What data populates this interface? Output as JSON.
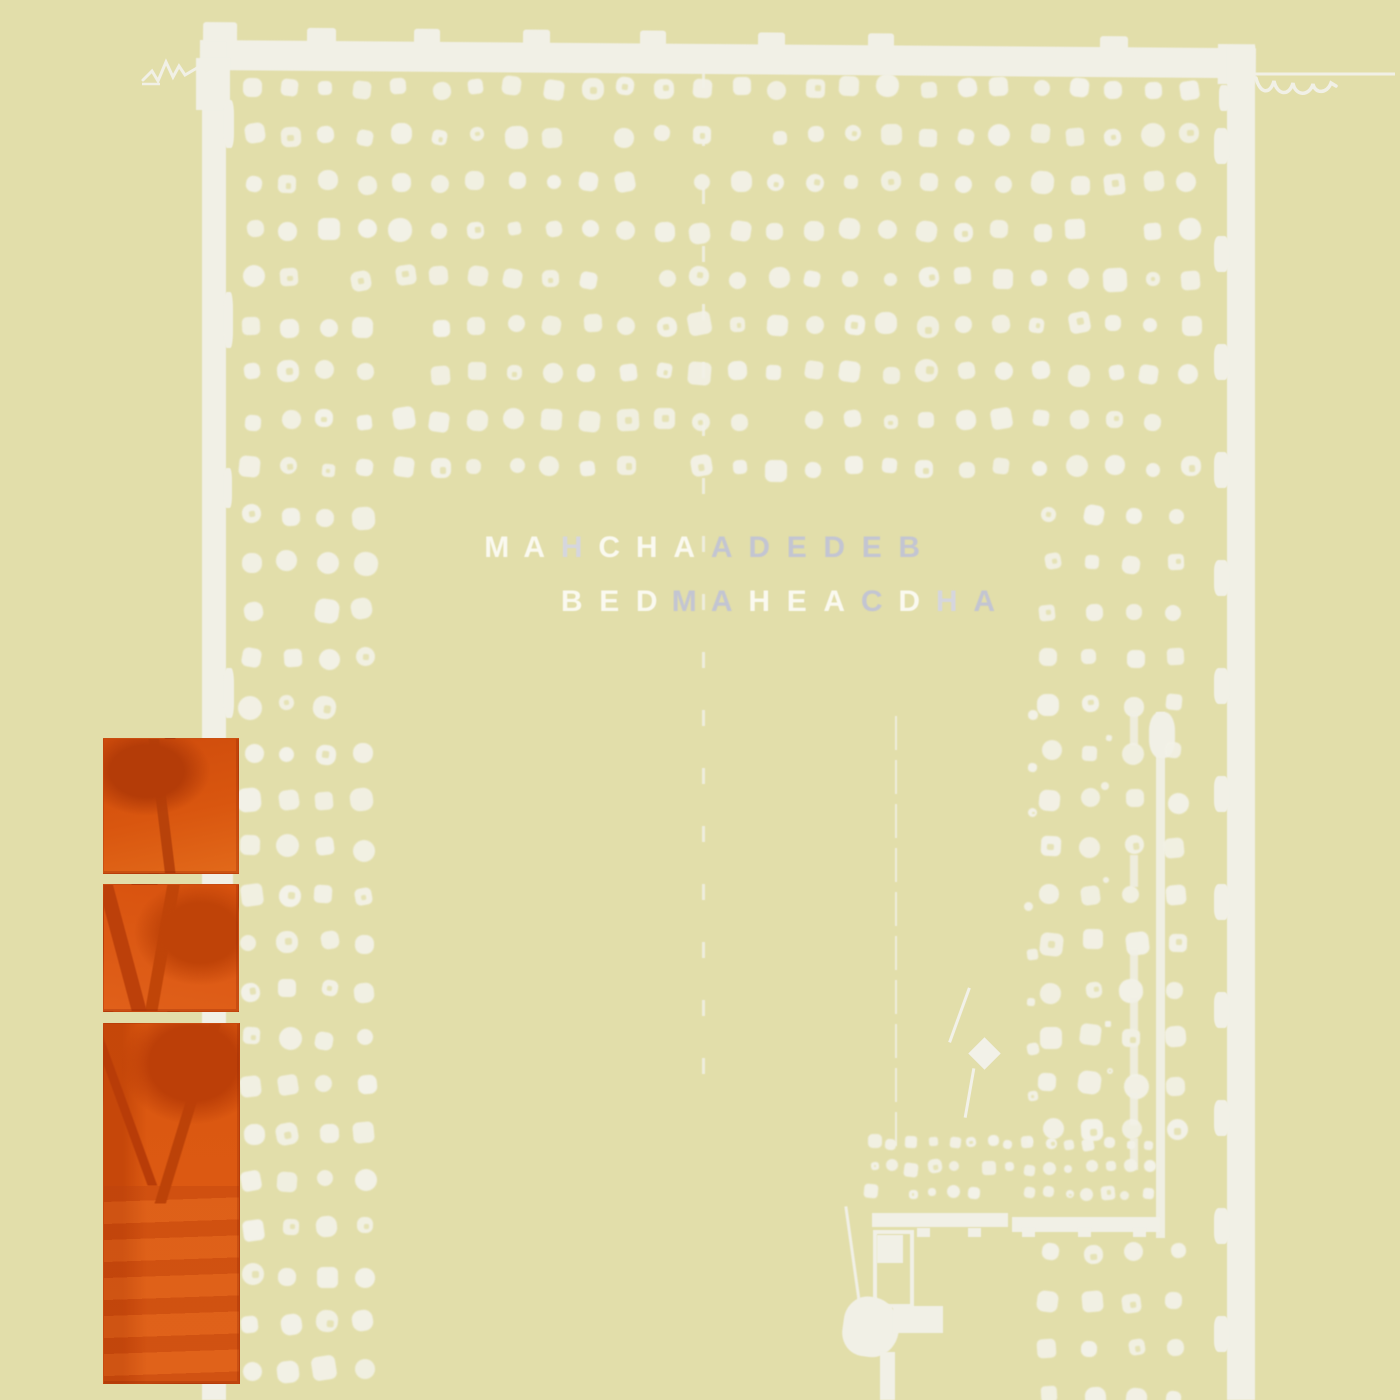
{
  "alt_text": "Pale khaki album-cover artwork: halftone field of off-white dots forming a building-like arch, white irregular frame strips on top/left/right, interleaved band-name lettering in the middle, three orange tree photo panels stacked at lower left, small machinery shapes at lower right.",
  "palette": {
    "background": "#e2deaa",
    "dot_white": "#f3f2e8",
    "frame_white": "#f1f0e6",
    "letter_white": "#faf9f0",
    "letter_gray": "#c3c5d2",
    "letter_faint": "#d5d6de",
    "orange_base": "#d9560f",
    "orange_dark": "#b83c08",
    "orange_light": "#e2691a"
  },
  "title": {
    "font_size": 30,
    "advance": 37.5,
    "line1": {
      "x": 478,
      "y": 531,
      "letters": [
        [
          "M",
          "white"
        ],
        [
          "A",
          "white"
        ],
        [
          "H",
          "faint"
        ],
        [
          "C",
          "white"
        ],
        [
          "H",
          "white"
        ],
        [
          "A",
          "white"
        ],
        [
          "A",
          "gray"
        ],
        [
          "D",
          "gray"
        ],
        [
          "E",
          "gray"
        ],
        [
          "D",
          "gray"
        ],
        [
          "E",
          "gray"
        ],
        [
          "B",
          "gray"
        ]
      ]
    },
    "line2": {
      "x": 553,
      "y": 585,
      "letters": [
        [
          "B",
          "white"
        ],
        [
          "E",
          "white"
        ],
        [
          "D",
          "white"
        ],
        [
          "M",
          "gray"
        ],
        [
          "A",
          "gray"
        ],
        [
          "H",
          "white"
        ],
        [
          "E",
          "white"
        ],
        [
          "A",
          "white"
        ],
        [
          "C",
          "gray"
        ],
        [
          "D",
          "white"
        ],
        [
          "H",
          "faint"
        ],
        [
          "A",
          "gray"
        ]
      ]
    }
  },
  "pattern": {
    "seed": 1337,
    "grid": {
      "x0": 252,
      "y0": 88,
      "dx": 37.5,
      "dy": 47.5,
      "cols": 26,
      "full_rows": 9,
      "left_cols": 4,
      "left_row_start": 9,
      "left_row_end": 27
    },
    "right_cols": [
      1050,
      1092,
      1134,
      1176
    ],
    "right_clean_rows": [
      515,
      562,
      610,
      657
    ],
    "right_messy_rows": [
      705,
      752,
      800,
      847,
      895,
      942,
      990,
      1037,
      1085,
      1130
    ],
    "mini_band": {
      "x0": 874,
      "y0": 1143,
      "dx": 19.5,
      "dy": 25,
      "cols": 15,
      "rows": 3,
      "size": 11
    },
    "bottom_block": {
      "cols": [
        1050,
        1092,
        1134,
        1176
      ],
      "rows": [
        1253,
        1301,
        1349,
        1397
      ]
    }
  },
  "frame": {
    "top_band": {
      "x": 200,
      "y": 40,
      "w": 1056,
      "h": 30,
      "bumps": [
        {
          "x": 203,
          "w": 34,
          "up": 18,
          "h": 48
        },
        {
          "x": 307,
          "w": 29,
          "up": 13,
          "h": 16
        },
        {
          "x": 414,
          "w": 26,
          "up": 13,
          "h": 16
        },
        {
          "x": 523,
          "w": 27,
          "up": 13,
          "h": 16
        },
        {
          "x": 640,
          "w": 26,
          "up": 13,
          "h": 16
        },
        {
          "x": 758,
          "w": 27,
          "up": 12,
          "h": 15
        },
        {
          "x": 868,
          "w": 26,
          "up": 12,
          "h": 15
        },
        {
          "x": 1100,
          "w": 28,
          "up": 11,
          "h": 14
        }
      ],
      "corner_block": {
        "x": 1218,
        "w": 37,
        "up": 4,
        "h": 40
      }
    },
    "left_bar": {
      "x": 202,
      "w": 24,
      "y0": 42,
      "y1": 1400,
      "head": {
        "x": 196,
        "y": 58,
        "w": 34,
        "h": 52
      },
      "tabs": [
        {
          "y": 100,
          "h": 48,
          "w": 10
        },
        {
          "y": 292,
          "h": 56,
          "w": 9
        },
        {
          "y": 468,
          "h": 40,
          "w": 8
        },
        {
          "y": 668,
          "h": 50,
          "w": 10
        },
        {
          "y": 856,
          "h": 44,
          "w": 9
        },
        {
          "y": 1050,
          "h": 40,
          "w": 8
        },
        {
          "y": 1244,
          "h": 46,
          "w": 9
        }
      ]
    },
    "right_bar": {
      "x": 1227,
      "w": 28,
      "y0": 46,
      "y1": 1400,
      "tabs": [
        {
          "y": 85,
          "h": 26,
          "w": 10
        },
        {
          "y": 128,
          "h": 36,
          "w": 15
        },
        {
          "y": 236,
          "h": 36,
          "w": 15
        },
        {
          "y": 344,
          "h": 36,
          "w": 15
        },
        {
          "y": 452,
          "h": 36,
          "w": 15
        },
        {
          "y": 560,
          "h": 36,
          "w": 15
        },
        {
          "y": 668,
          "h": 36,
          "w": 15
        },
        {
          "y": 776,
          "h": 36,
          "w": 15
        },
        {
          "y": 884,
          "h": 36,
          "w": 15
        },
        {
          "y": 992,
          "h": 36,
          "w": 15
        },
        {
          "y": 1100,
          "h": 36,
          "w": 15
        },
        {
          "y": 1208,
          "h": 36,
          "w": 15
        },
        {
          "y": 1316,
          "h": 36,
          "w": 15
        }
      ]
    }
  },
  "lines": {
    "center_dashed": {
      "x": 702,
      "y0": 72,
      "y1": 1092,
      "w": 3,
      "dash": 16,
      "gap": 42
    },
    "mid_thin": {
      "x": 895,
      "y0": 716,
      "y1": 1146,
      "w": 2,
      "dash": 34,
      "gap": 10
    },
    "pole": {
      "x": 1156,
      "y0": 712,
      "y1": 1238,
      "w": 9,
      "cap": {
        "x": 1149,
        "y": 712,
        "w": 26,
        "h": 46
      }
    }
  },
  "kite": {
    "cx": 984,
    "cy": 1053,
    "size": 23,
    "string": {
      "x": 958,
      "y": 986,
      "h": 58,
      "rot": 20
    },
    "tail": {
      "x": 968,
      "y": 1068,
      "h": 50,
      "rot": 10
    }
  },
  "machine": {
    "bars": [
      {
        "x": 872,
        "y": 1213,
        "w": 136,
        "h": 14
      },
      {
        "x": 1012,
        "y": 1217,
        "w": 148,
        "h": 15
      }
    ],
    "feet_x": [
      917,
      968,
      1022,
      1078,
      1133
    ],
    "foot": {
      "w": 13,
      "h": 9,
      "y": 1228
    },
    "door": {
      "x": 873,
      "y": 1230,
      "w": 33,
      "h": 70,
      "stroke": 4,
      "block": {
        "x": 877,
        "y": 1235,
        "w": 26,
        "h": 28
      }
    },
    "scratch": {
      "x": 851,
      "y": 1206,
      "h": 96,
      "rot": 8
    },
    "blob": {
      "cx": 871,
      "cy": 1327,
      "rx": 28,
      "ry": 30
    },
    "arm": {
      "x": 893,
      "y": 1306,
      "w": 50,
      "h": 27
    },
    "leg": {
      "x": 880,
      "y": 1352,
      "w": 15,
      "h": 48
    }
  },
  "orange_panels": [
    {
      "x": 103,
      "y": 738,
      "w": 134,
      "h": 134,
      "art": 1
    },
    {
      "x": 103,
      "y": 884,
      "w": 134,
      "h": 126,
      "art": 2
    },
    {
      "x": 103,
      "y": 1023,
      "w": 135,
      "h": 359,
      "art": 3
    }
  ]
}
